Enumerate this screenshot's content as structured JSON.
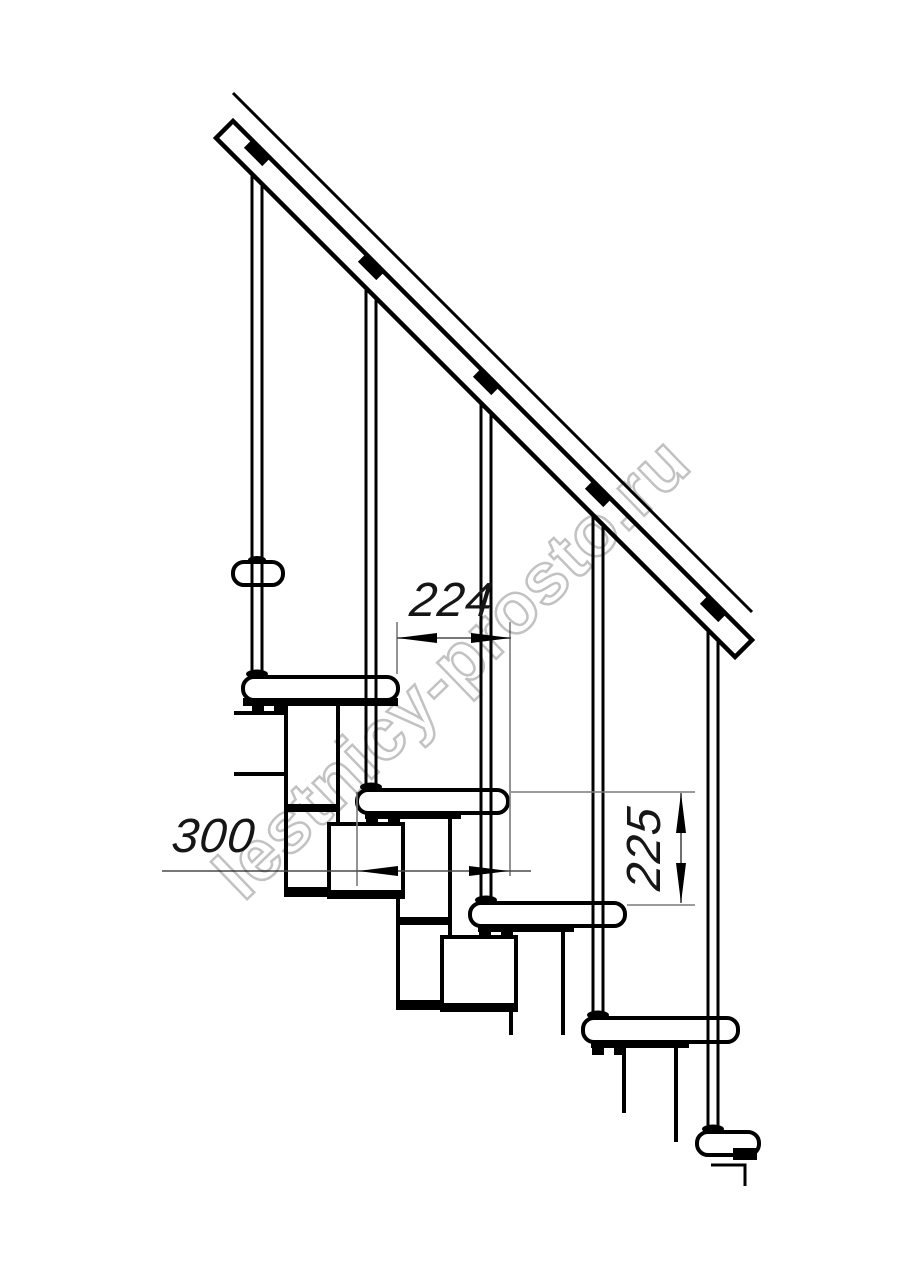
{
  "page": {
    "background": "#ffffff",
    "kind": "technical line drawing — modular staircase, side elevation"
  },
  "watermark": {
    "text": "lestnicy-prosto.ru",
    "color": "#c2c2c2"
  },
  "annotations": {
    "dim_step_run": {
      "label": "224",
      "orientation": "horizontal"
    },
    "dim_tread_depth": {
      "label": "300",
      "orientation": "horizontal"
    },
    "dim_step_height": {
      "label": "225",
      "orientation": "vertical"
    }
  },
  "drawing": {
    "ink_color": "#000000",
    "thin_line_color": "#7a7a7a",
    "treads_visible": 5,
    "balusters_visible": 5,
    "handrail_angle_deg": 45
  }
}
